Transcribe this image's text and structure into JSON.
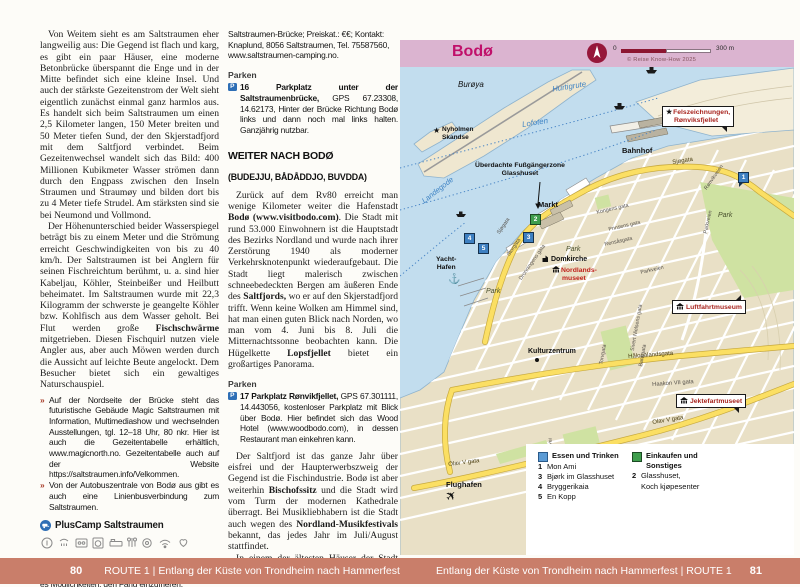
{
  "colors": {
    "footer_bg": "#c97e6a",
    "map_band": "#dbb4d0",
    "title_magenta": "#c0106a",
    "red_map_label": "#a8251f",
    "sea": "#c2ddee",
    "park_green": "#cfe2a2",
    "road_yellow": "#fbdf63",
    "legend_blue": "#5b9bd5",
    "legend_green": "#3f9e4d",
    "tip_bullet_red": "#a63b28",
    "parking_blue": "#2e6eb5"
  },
  "left_column": {
    "para1": "Von Weitem sieht es am Saltstraumen eher langweilig aus: Die Gegend ist flach und karg, es gibt ein paar Häuser, eine moderne Betonbrücke überspannt die Enge und in der Mitte befindet sich eine kleine Insel. Und auch der stärkste Gezeitenstrom der Welt sieht eigentlich zunächst einmal ganz harmlos aus. Es handelt sich beim Saltstraumen um einen 2,5 Kilometer langen, 150 Meter breiten und 50 Meter tiefen Sund, der den Skjerstadfjord mit dem Saltfjord verbindet. Beim Gezeitenwechsel wandelt sich das Bild: 400 Millionen Kubikmeter Wasser strömen dann durch den Engpass zwischen den Inseln Straumen und Straumøy und bilden dort bis zu 4 Meter tiefe Strudel. Am stärksten sind sie bei Neumond und Vollmond.",
    "para2": {
      "seg0": "Der Höhenunterschied beider Wasserspiegel beträgt bis zu einem Meter und die Strömung erreicht Geschwindigkeiten von bis zu 40 km/h. Der Saltstraumen ist bei Anglern für seinen Fischreichtum berühmt, u. a. sind hier Kabeljau, Köhler, Steinbeißer und Heilbutt beheimatet. Im Saltstraumen wurde mit 22,3 Kilogramm der schwerste je geangelte Köhler bzw. Kohlfisch aus dem Wasser geholt. Bei Flut werden große ",
      "seg1_bold": "Fischschwärme",
      "seg2": " mitgetrieben. Diesen Fischquirl nutzen viele Angler aus, aber auch Möwen werden durch die Aussicht auf leichte Beute angelockt. Dem Besucher bietet sich ein gewaltiges Naturschauspiel."
    },
    "tip_bullet": "»",
    "tip1": "Auf der Nordseite der Brücke steht das futuristische Gebäude Magic Saltstraumen mit Information, Multimediashow und wechselnden Ausstellungen, tgl. 12–18 Uhr, 80 nkr. Hier ist auch die Gezeitentabelle erhältlich, www.magicnorth.no. Gezeitentabelle auch auf der Website https://saltstraumen.info/Velkommen.",
    "tip2": "Von der Autobuszentrale von Bodø aus gibt es auch eine Linienbusverbindung zum Saltstraumen.",
    "campsite": {
      "name": "PlusCamp Saltstraumen",
      "type_icon": "campsite-icon",
      "amenity_icons": [
        "reception-icon",
        "shower-icon",
        "kitchen-icon",
        "laundry-icon",
        "bed-icon",
        "wc-icon",
        "dishwashing-icon",
        "wifi-icon",
        "pets-icon"
      ],
      "gps": "GPS 67.235969, 14.621243",
      "description": "Hotel, Café, Kneipe und ein Laden. Für Angler gibt es Möglichkeiten, den Fang einzufrieren. Lage/Anfahrt: an der"
    }
  },
  "middle_column": {
    "contact": "Saltstraumen-Brücke; Preiskat.: €€; Kontakt: Knaplund, 8056 Saltstraumen, Tel. 75587560, www.saltstraumen-camping.no.",
    "parken_heading": "Parken",
    "p16": {
      "icon": "P",
      "number": "16",
      "lead_bold": "Parkplatz unter der Saltstraumenbrücke,",
      "rest": " GPS 67.23308, 14.62173, Hinter der Brücke Richtung Bodø links und dann noch mal links halten. Ganzjährig nutzbar."
    },
    "section_heading": "WEITER NACH BODØ",
    "section_subheading": "(BUDEJJU, BÅDÅDDJO, BUVDDA)",
    "para1": {
      "seg0": "Zurück auf dem Rv80 erreicht man wenige Kilometer weiter die Hafenstadt ",
      "seg1_bold": "Bodø (www.visitbodo.com)",
      "seg2": ". Die Stadt mit rund 53.000 Einwohnern ist die Hauptstadt des Bezirks Nordland und wurde nach ihrer Zerstörung 1940 als moderner Verkehrsknotenpunkt wiederaufgebaut. Die Stadt liegt malerisch zwischen schneebedeckten Bergen am äußeren Ende des ",
      "seg3_bold": "Saltfjords,",
      "seg4": " wo er auf den Skjerstadfjord trifft. Wenn keine Wolken am Himmel sind, hat man einen guten Blick nach Norden, wo man vom 4. Juni bis 8. Juli die Mitternachtssonne beobachten kann. Die Hügelkette ",
      "seg5_bold": "Lopsfjellet",
      "seg6": " bietet ein großartiges Panorama."
    },
    "parken_heading2": "Parken",
    "p17": {
      "icon": "P",
      "number": "17",
      "lead_bold": "Parkplatz Rønvikfjellet,",
      "rest": " GPS 67.301111, 14.443056, kostenloser Parkplatz mit Blick über Bodø. Hier befindet sich das Wood Hotel (www.woodbodo.com), in dessen Restaurant man einkehren kann."
    },
    "para2": {
      "seg0": "Der Saltfjord ist das ganze Jahr über eisfrei und der Haupterwerbszweig der Gegend ist die Fischindustrie. Bodø ist aber weiterhin ",
      "seg1_bold": "Bischofssitz",
      "seg2": " und die Stadt wird vom Turm der modernen Kathedrale überragt. Bei Musikliebhabern ist die Stadt auch wegen des ",
      "seg3_bold": "Nordland-Musikfestivals",
      "seg4": " bekannt, das jedes Jahr im Juli/August stattfindet."
    },
    "para3": {
      "seg0": "In einem der ältesten Häuser der Stadt befindet sich das ",
      "seg1_bold": "Nordlandmuseum",
      "seg2": ". Ein"
    }
  },
  "map": {
    "title": "Bodø",
    "copyright": "© Reise Know-How 2025",
    "scale_start": "0",
    "scale_end": "300 m",
    "ferry_routes": {
      "hurtigrute": "Hurtigrute",
      "lofoten": "Lofoten",
      "landegode": "Landegode"
    },
    "places": {
      "buroya": "Burøya",
      "nyholmen_line1": "Nyholmen",
      "nyholmen_line2": "Skandse",
      "felszeichnungen_line1": "Felszeichnungen,",
      "felszeichnungen_line2": "Rønviksfjellet",
      "bahnhof": "Bahnhof",
      "fussgaengerzone_line1": "Überdachte Fußgängerzone",
      "fussgaengerzone_line2": "Glasshuset",
      "markt": "Markt",
      "yachthafen_line1": "Yacht-",
      "yachthafen_line2": "Hafen",
      "domkirche": "Domkirche",
      "nordlandsmuseet_line1": "Nordlands-",
      "nordlandsmuseet_line2": "museet",
      "park": "Park",
      "kulturzentrum": "Kulturzentrum",
      "luftfahrtmuseum": "Luftfahrtmuseum",
      "jektefartmuseet": "Jektefartmuseet",
      "flughafen": "Flughafen"
    },
    "streets": {
      "sjogata": "Sjøgata",
      "storgata": "Storgata",
      "dronningens": "Dronningens gata",
      "kongens": "Kongens gata",
      "prinsens": "Prinsens gata",
      "rensasgata": "Rensåsgata",
      "parkveien": "Parkveien",
      "sivert": "Sivert Nielsens gata",
      "torvgata": "Torvgata",
      "bankgata": "Bankgata",
      "fridtjof": "Fridtjof Nansens vei",
      "ronvikveien": "Rønvikveien",
      "halogalandsgata": "Hålogalandsgata",
      "haakon": "Haakon VII gata",
      "olav": "Olav V gata"
    },
    "markers": {
      "m1": "1",
      "m2": "2",
      "m3": "3",
      "m4": "4",
      "m5": "5"
    },
    "legend": {
      "eat_heading": "Essen und Trinken",
      "eat_items": [
        {
          "n": "1",
          "label": "Mon Ami"
        },
        {
          "n": "3",
          "label": "Bjørk im Glasshuset"
        },
        {
          "n": "4",
          "label": "Bryggerikaia"
        },
        {
          "n": "5",
          "label": "En Kopp"
        }
      ],
      "shop_heading_line1": "Einkaufen und",
      "shop_heading_line2": "Sonstiges",
      "shop_item_n": "2",
      "shop_item_line1": "Glasshuset,",
      "shop_item_line2": "Koch kjøpesenter"
    }
  },
  "footer": {
    "left": {
      "page_number": "80",
      "label": "ROUTE 1 | Entlang der Küste von Trondheim nach Hammerfest"
    },
    "right": {
      "label": "Entlang der Küste von Trondheim nach Hammerfest | ROUTE 1",
      "page_number": "81"
    }
  }
}
